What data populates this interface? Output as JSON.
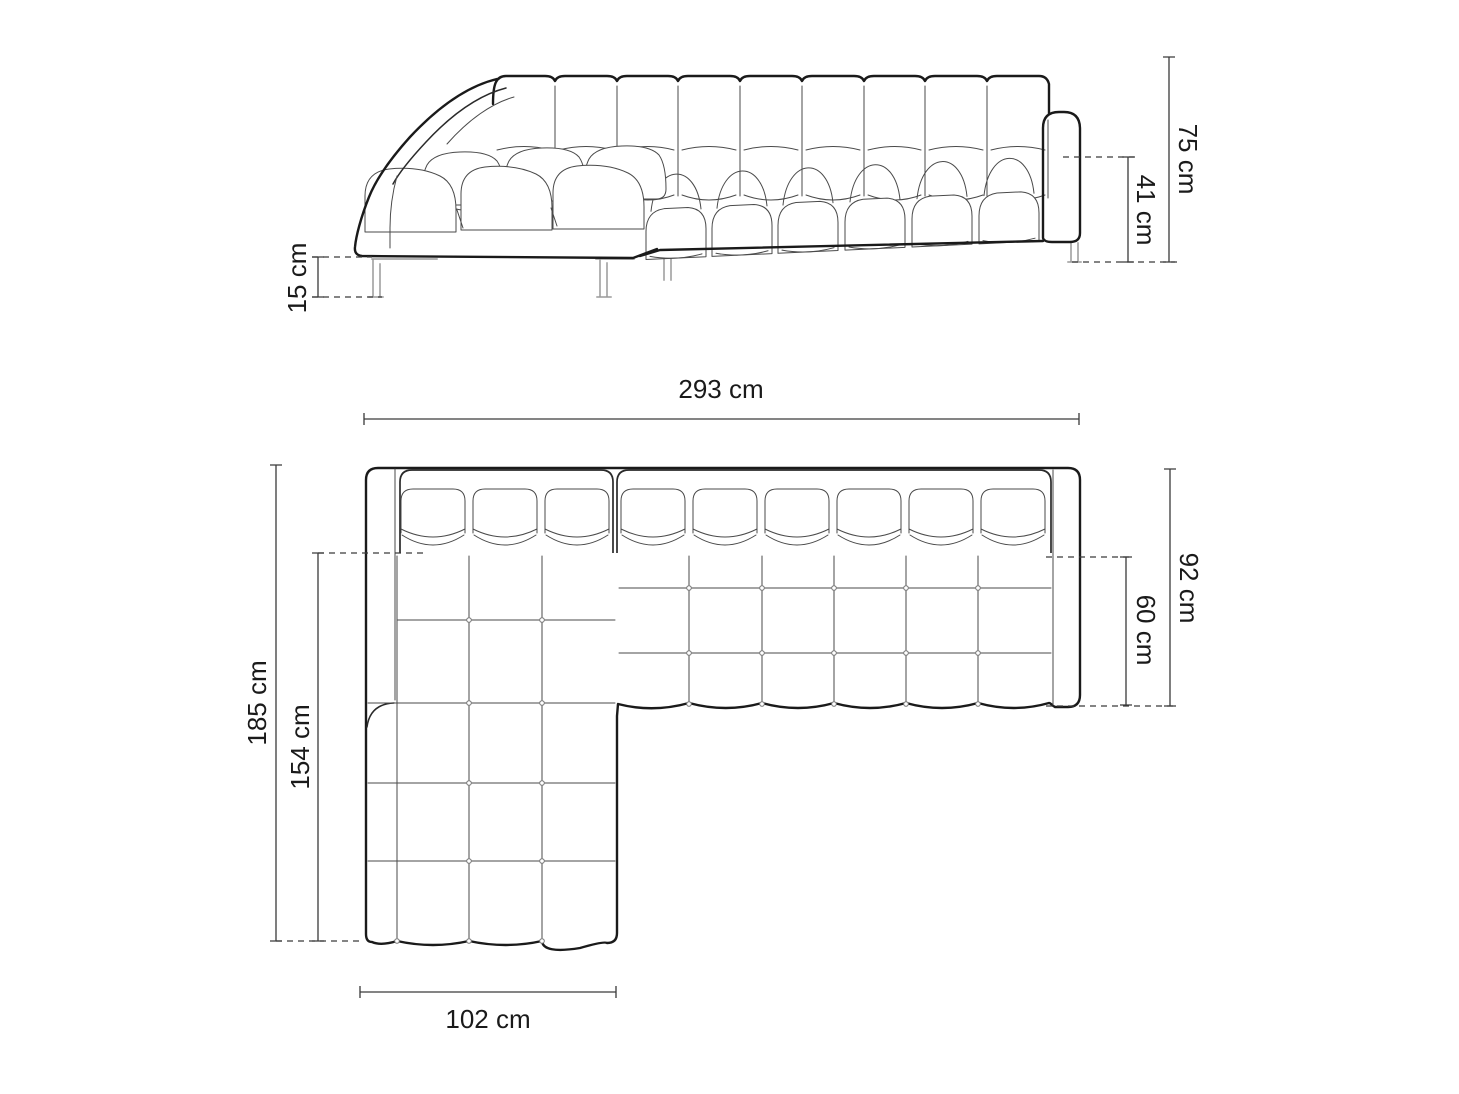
{
  "front_view": {
    "dims": {
      "total_height": "75 cm",
      "seat_height": "41 cm",
      "leg_height": "15 cm"
    }
  },
  "top_view": {
    "dims": {
      "total_width": "293 cm",
      "total_depth": "92 cm",
      "seat_depth": "60 cm",
      "chaise_depth": "185 cm",
      "chaise_seat_depth": "154 cm",
      "chaise_width": "102 cm"
    }
  },
  "colors": {
    "background": "#ffffff",
    "outline": "#1a1a1a",
    "detail": "#4a4a4a",
    "legs": "#9a9a9a",
    "dimension": "#3a3a3a"
  }
}
